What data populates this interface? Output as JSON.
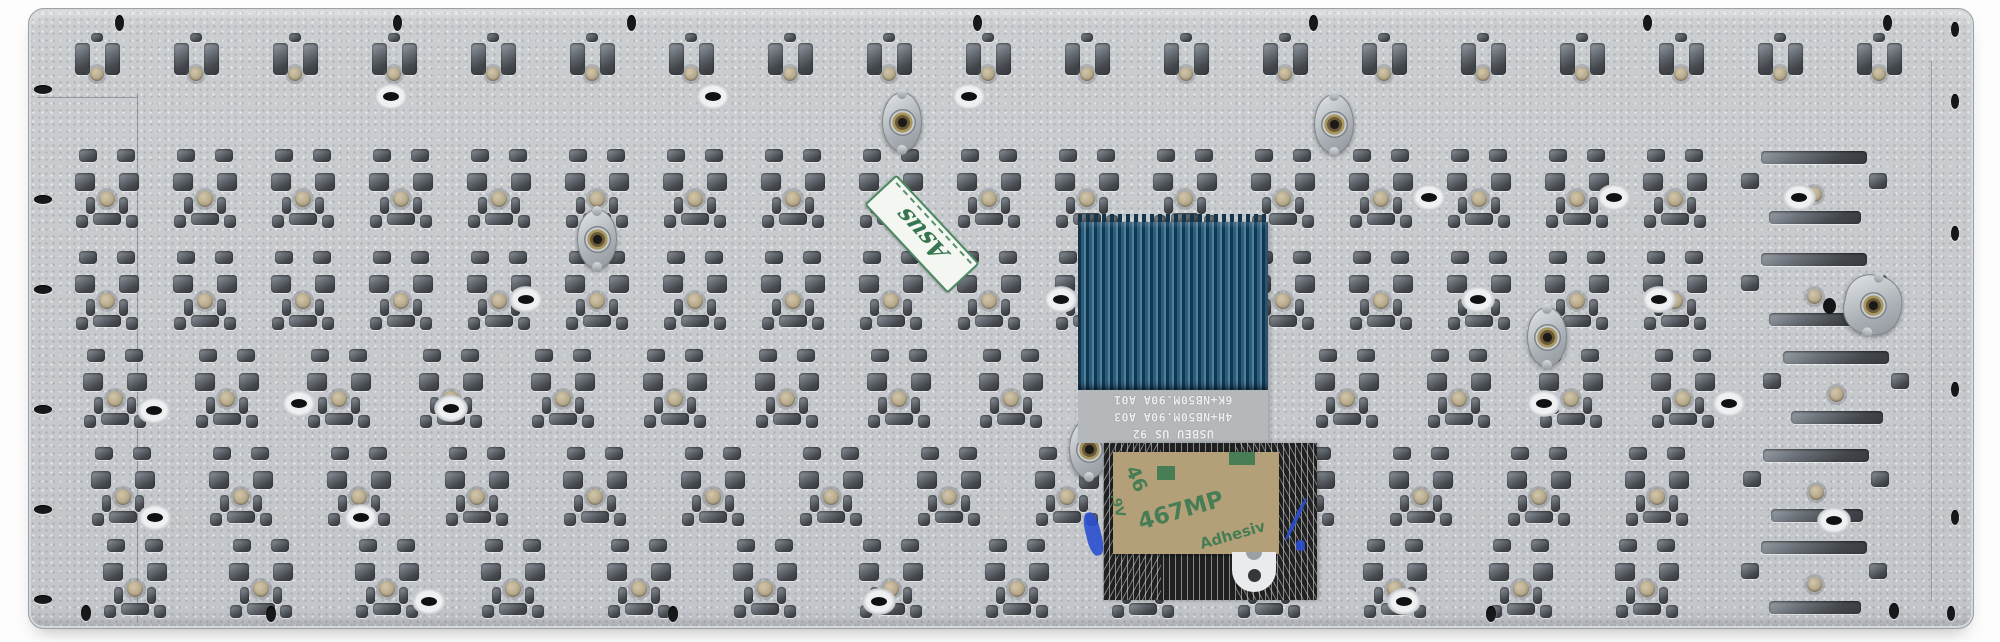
{
  "scene": {
    "title": "laptop keyboard metal backplate, rear view with ribbon cable",
    "background_color": "#fdfdfd"
  },
  "plate": {
    "x": 28,
    "y": 8,
    "w": 1944,
    "h": 619,
    "radius": 16,
    "base_color": "#c6c9cc",
    "cutout_color": "#43474c",
    "dome_color": "#b3a587",
    "rows": [
      {
        "variant": "fn",
        "y": 30,
        "start": 64,
        "pitch": 99,
        "count": 19,
        "wide_end": false
      },
      {
        "variant": "std",
        "y": 148,
        "start": 72,
        "pitch": 98,
        "count": 18,
        "wide_end": true
      },
      {
        "variant": "std",
        "y": 250,
        "start": 72,
        "pitch": 98,
        "count": 18,
        "wide_end": true
      },
      {
        "variant": "std",
        "y": 348,
        "start": 80,
        "pitch": 112,
        "count": 16,
        "wide_end": true
      },
      {
        "variant": "std",
        "y": 446,
        "start": 88,
        "pitch": 118,
        "count": 15,
        "wide_end": true
      },
      {
        "variant": "std",
        "y": 538,
        "start": 100,
        "pitch": 126,
        "count": 14,
        "wide_end": true
      }
    ],
    "ring_holes": [
      [
        390,
        95
      ],
      [
        712,
        95
      ],
      [
        968,
        95
      ],
      [
        1428,
        196
      ],
      [
        1613,
        196
      ],
      [
        1798,
        196
      ],
      [
        525,
        298
      ],
      [
        1060,
        298
      ],
      [
        1477,
        298
      ],
      [
        1658,
        298
      ],
      [
        298,
        402
      ],
      [
        1543,
        402
      ],
      [
        1728,
        402
      ],
      [
        153,
        409
      ],
      [
        450,
        407
      ],
      [
        360,
        516
      ],
      [
        154,
        516
      ],
      [
        1833,
        519
      ],
      [
        428,
        600
      ],
      [
        878,
        600
      ],
      [
        1403,
        600
      ]
    ],
    "top_holes": [
      [
        118,
        22
      ],
      [
        396,
        22
      ],
      [
        630,
        22
      ],
      [
        976,
        22
      ],
      [
        1312,
        22
      ],
      [
        1646,
        22
      ],
      [
        1886,
        22
      ]
    ],
    "left_holes": [
      [
        42,
        88
      ],
      [
        42,
        198
      ],
      [
        42,
        288
      ],
      [
        42,
        408
      ],
      [
        42,
        508
      ],
      [
        42,
        598
      ]
    ],
    "right_holes": [
      [
        1954,
        28
      ],
      [
        1954,
        100
      ],
      [
        1954,
        232
      ],
      [
        1954,
        388
      ],
      [
        1954,
        516
      ],
      [
        1950,
        612
      ]
    ],
    "bottom_holes": [
      [
        85,
        612
      ],
      [
        270,
        613
      ],
      [
        672,
        613
      ],
      [
        1490,
        613
      ],
      [
        1893,
        610
      ]
    ],
    "bosses": [
      [
        900,
        120,
        0
      ],
      [
        1332,
        122,
        0
      ],
      [
        595,
        237,
        0
      ],
      [
        1545,
        335,
        0
      ],
      [
        1087,
        447,
        0
      ],
      [
        1862,
        303,
        1
      ]
    ],
    "seams": [
      [
        136,
        92,
        1,
        528
      ],
      [
        36,
        96,
        100,
        1
      ],
      [
        1930,
        60,
        1,
        540
      ]
    ]
  },
  "cable": {
    "x": 1078,
    "top": 222,
    "blue_w": 190,
    "blue_h": 168,
    "print_h": 53,
    "fan_x": 1103,
    "fan_w": 214,
    "fan_h": 157,
    "blue_color": "#2c5e7e",
    "print_bg": "#b4b8bb",
    "fan_bg": "#202020",
    "print_lines": [
      "6K+NB50M.90A A01",
      "4H+NB50M.90A A03",
      "USBEU US 92"
    ],
    "notch": {
      "x": 1232,
      "y": 552,
      "w": 44,
      "h": 40
    },
    "ink_color": "#2b4fd0",
    "ink_marks": [
      [
        1086,
        512,
        15,
        44,
        -14
      ],
      [
        1294,
        496,
        4,
        46,
        26
      ],
      [
        1296,
        540,
        9,
        11,
        0
      ]
    ]
  },
  "stickers": {
    "qc": {
      "text": "Asus",
      "cx": 920,
      "cy": 232,
      "w": 118,
      "h": 40,
      "rotate": 47,
      "border_color": "#4a8862",
      "text_color": "#35754f",
      "bg": "#f4f6f1"
    },
    "adhesive": {
      "x": 1113,
      "y": 452,
      "w": 166,
      "h": 102,
      "bg": "#b3a078",
      "text_color": "#3c7a52",
      "fragments": [
        {
          "text": "46",
          "x": 10,
          "y": 16,
          "rot": 66,
          "size": 19
        },
        {
          "text": ".9V",
          "x": -8,
          "y": 46,
          "rot": 74,
          "size": 13
        },
        {
          "text": "467MP",
          "x": 24,
          "y": 46,
          "rot": -16,
          "size": 23
        },
        {
          "text": "Adhesiv",
          "x": 86,
          "y": 74,
          "rot": -16,
          "size": 15
        }
      ],
      "logo_squares": [
        [
          44,
          14,
          18,
          14
        ],
        [
          116,
          0,
          26,
          13
        ]
      ]
    }
  }
}
